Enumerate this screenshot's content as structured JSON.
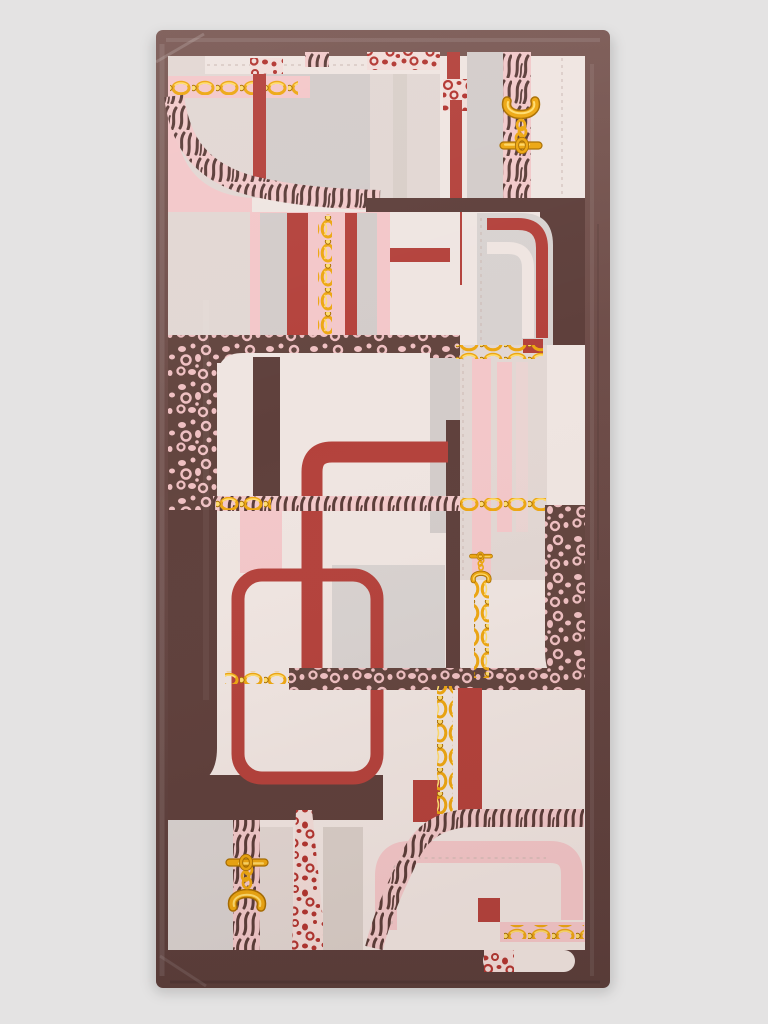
{
  "image": {
    "alt": "Product photo of a folded rectangular silk scarf on a plain light grey background. The scarf has a solid chocolate-brown border and a geometric patchwork print of cream, beige, grey and blush-pink blocks crossed by brick-red rounded-corner frames, brown leopard-print panels with pink spots, red leopard patches, pink-and-brown zebra straps, and golden chain rows finished with gold toggle clasps.",
    "subject": "printed-scarf",
    "orientation": "portrait"
  },
  "motifs": [
    "brown-border",
    "patchwork-color-blocks",
    "leopard-print-panel",
    "red-leopard-patch",
    "zebra-strap",
    "red-rounded-frame",
    "gold-chain-row",
    "gold-toggle-clasp"
  ],
  "palette": {
    "pageBg": "#e4e3e3",
    "borderLight": "#7b5a55",
    "borderBrown": "#6b4a46",
    "borderDark": "#593d3a",
    "panelBrown": "#5f403c",
    "cream": "#efe5e1",
    "beige": "#e2d7d3",
    "taupe": "#d9cfc9",
    "gray": "#d3ccca",
    "gray2": "#d8d2d0",
    "pink": "#f3c7c9",
    "pinkSoft": "#ead4d2",
    "red": "#b4423c",
    "gold": "#eda712",
    "goldLight": "#ffdd6f",
    "goldDark": "#a96f02",
    "zebraPink": "#f2c9ca",
    "zebraBrown": "#5b3d39",
    "leoBrown": "#63453f",
    "leoPink": "#efc0c2",
    "leoRedBg": "#f2ddd9",
    "leoRed": "#b23530",
    "stitch": "#cdbab4"
  }
}
